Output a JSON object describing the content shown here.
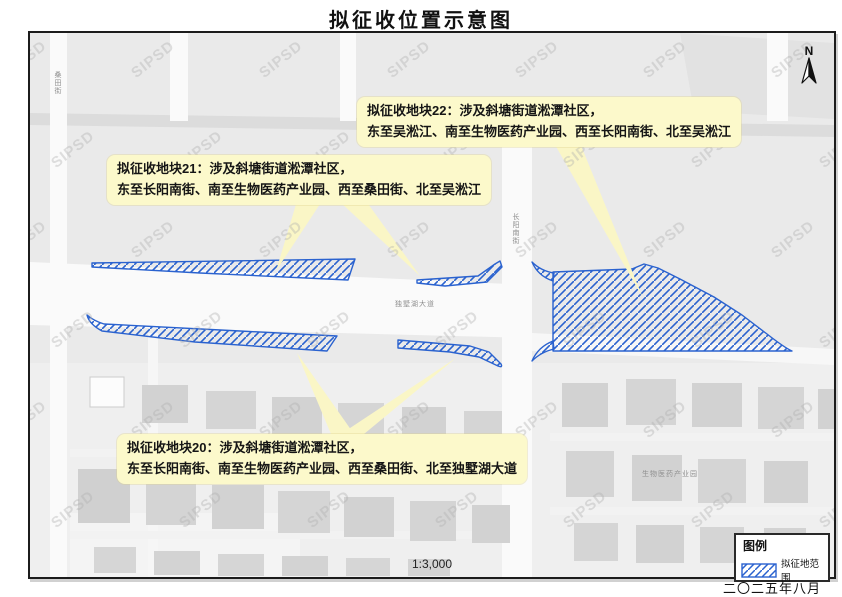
{
  "title": "拟征收位置示意图",
  "north_label": "N",
  "scale_text": "1:3,000",
  "date_text": "二〇二五年八月",
  "watermark": {
    "text": "SIPSD"
  },
  "legend": {
    "title": "图例",
    "item_label": "拟征地范围",
    "swatch": "blue-diagonal-hatch"
  },
  "colors": {
    "hatch_blue": "#2a62cf",
    "callout_yellow": "#fcf9cb",
    "map_bg": "#eaeaea",
    "road_white": "#fafafa",
    "river_gray": "#dcdcdc",
    "building_gray": "#d2d2d2"
  },
  "callouts": {
    "block22": {
      "line1": "拟征收地块22：涉及斜塘街道淞潭社区，",
      "line2": "东至吴淞江、南至生物医药产业园、西至长阳南街、北至吴淞江"
    },
    "block21": {
      "line1": "拟征收地块21：涉及斜塘街道淞潭社区，",
      "line2": "东至长阳南街、南至生物医药产业园、西至桑田街、北至吴淞江"
    },
    "block20": {
      "line1": "拟征收地块20：涉及斜塘街道淞潭社区，",
      "line2": "东至长阳南街、南至生物医药产业园、西至桑田街、北至独墅湖大道"
    }
  },
  "road_labels": {
    "sangtian": "桑田街",
    "changyang": "长阳南街",
    "dushu": "独墅湖大道",
    "biobay": "生物医药产业园"
  }
}
